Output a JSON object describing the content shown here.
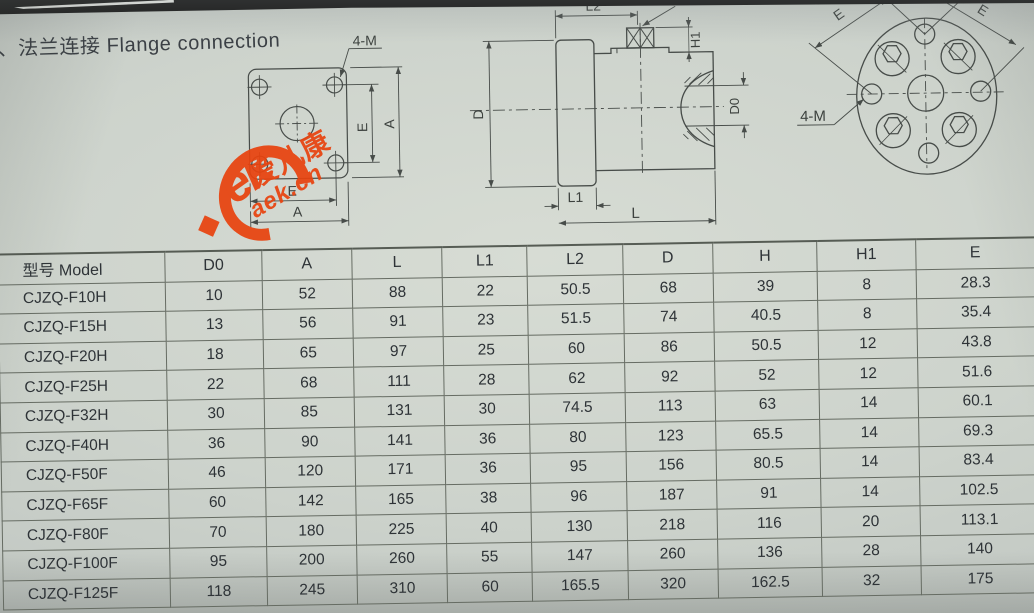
{
  "page": {
    "title": "2、法兰连接 Flange connection"
  },
  "watermark": {
    "glyph": "ek",
    "name_zh": "爱儿康",
    "domain": "aek.cn",
    "star": "◆",
    "color": "#e8430f"
  },
  "drawings": {
    "front_view": {
      "labels": {
        "bolt": "4-M",
        "e_v": "E",
        "a_v": "A",
        "e_h": "E",
        "a_h": "A"
      }
    },
    "side_view": {
      "labels": {
        "l2": "L2",
        "sw": "SW",
        "h1": "H1",
        "d": "D",
        "d0": "D0",
        "l1": "L1",
        "l": "L"
      }
    },
    "circular_view": {
      "labels": {
        "e_left": "E",
        "e_right": "E",
        "bolt": "4-M"
      }
    }
  },
  "table": {
    "columns": [
      "型号 Model",
      "D0",
      "A",
      "L",
      "L1",
      "L2",
      "D",
      "H",
      "H1",
      "E"
    ],
    "rows": [
      [
        "CJZQ-F10H",
        "10",
        "52",
        "88",
        "22",
        "50.5",
        "68",
        "39",
        "8",
        "28.3"
      ],
      [
        "CJZQ-F15H",
        "13",
        "56",
        "91",
        "23",
        "51.5",
        "74",
        "40.5",
        "8",
        "35.4"
      ],
      [
        "CJZQ-F20H",
        "18",
        "65",
        "97",
        "25",
        "60",
        "86",
        "50.5",
        "12",
        "43.8"
      ],
      [
        "CJZQ-F25H",
        "22",
        "68",
        "111",
        "28",
        "62",
        "92",
        "52",
        "12",
        "51.6"
      ],
      [
        "CJZQ-F32H",
        "30",
        "85",
        "131",
        "30",
        "74.5",
        "113",
        "63",
        "14",
        "60.1"
      ],
      [
        "CJZQ-F40H",
        "36",
        "90",
        "141",
        "36",
        "80",
        "123",
        "65.5",
        "14",
        "69.3"
      ],
      [
        "CJZQ-F50F",
        "46",
        "120",
        "171",
        "36",
        "95",
        "156",
        "80.5",
        "14",
        "83.4"
      ],
      [
        "CJZQ-F65F",
        "60",
        "142",
        "165",
        "38",
        "96",
        "187",
        "91",
        "14",
        "102.5"
      ],
      [
        "CJZQ-F80F",
        "70",
        "180",
        "225",
        "40",
        "130",
        "218",
        "116",
        "20",
        "113.1"
      ],
      [
        "CJZQ-F100F",
        "95",
        "200",
        "260",
        "55",
        "147",
        "260",
        "136",
        "28",
        "140"
      ],
      [
        "CJZQ-F125F",
        "118",
        "245",
        "310",
        "60",
        "165.5",
        "320",
        "162.5",
        "32",
        "175"
      ]
    ]
  },
  "colors": {
    "paper": "#ccd2cb",
    "line": "#474c49",
    "text": "#2e3337",
    "watermark_red": "#e8430f"
  }
}
